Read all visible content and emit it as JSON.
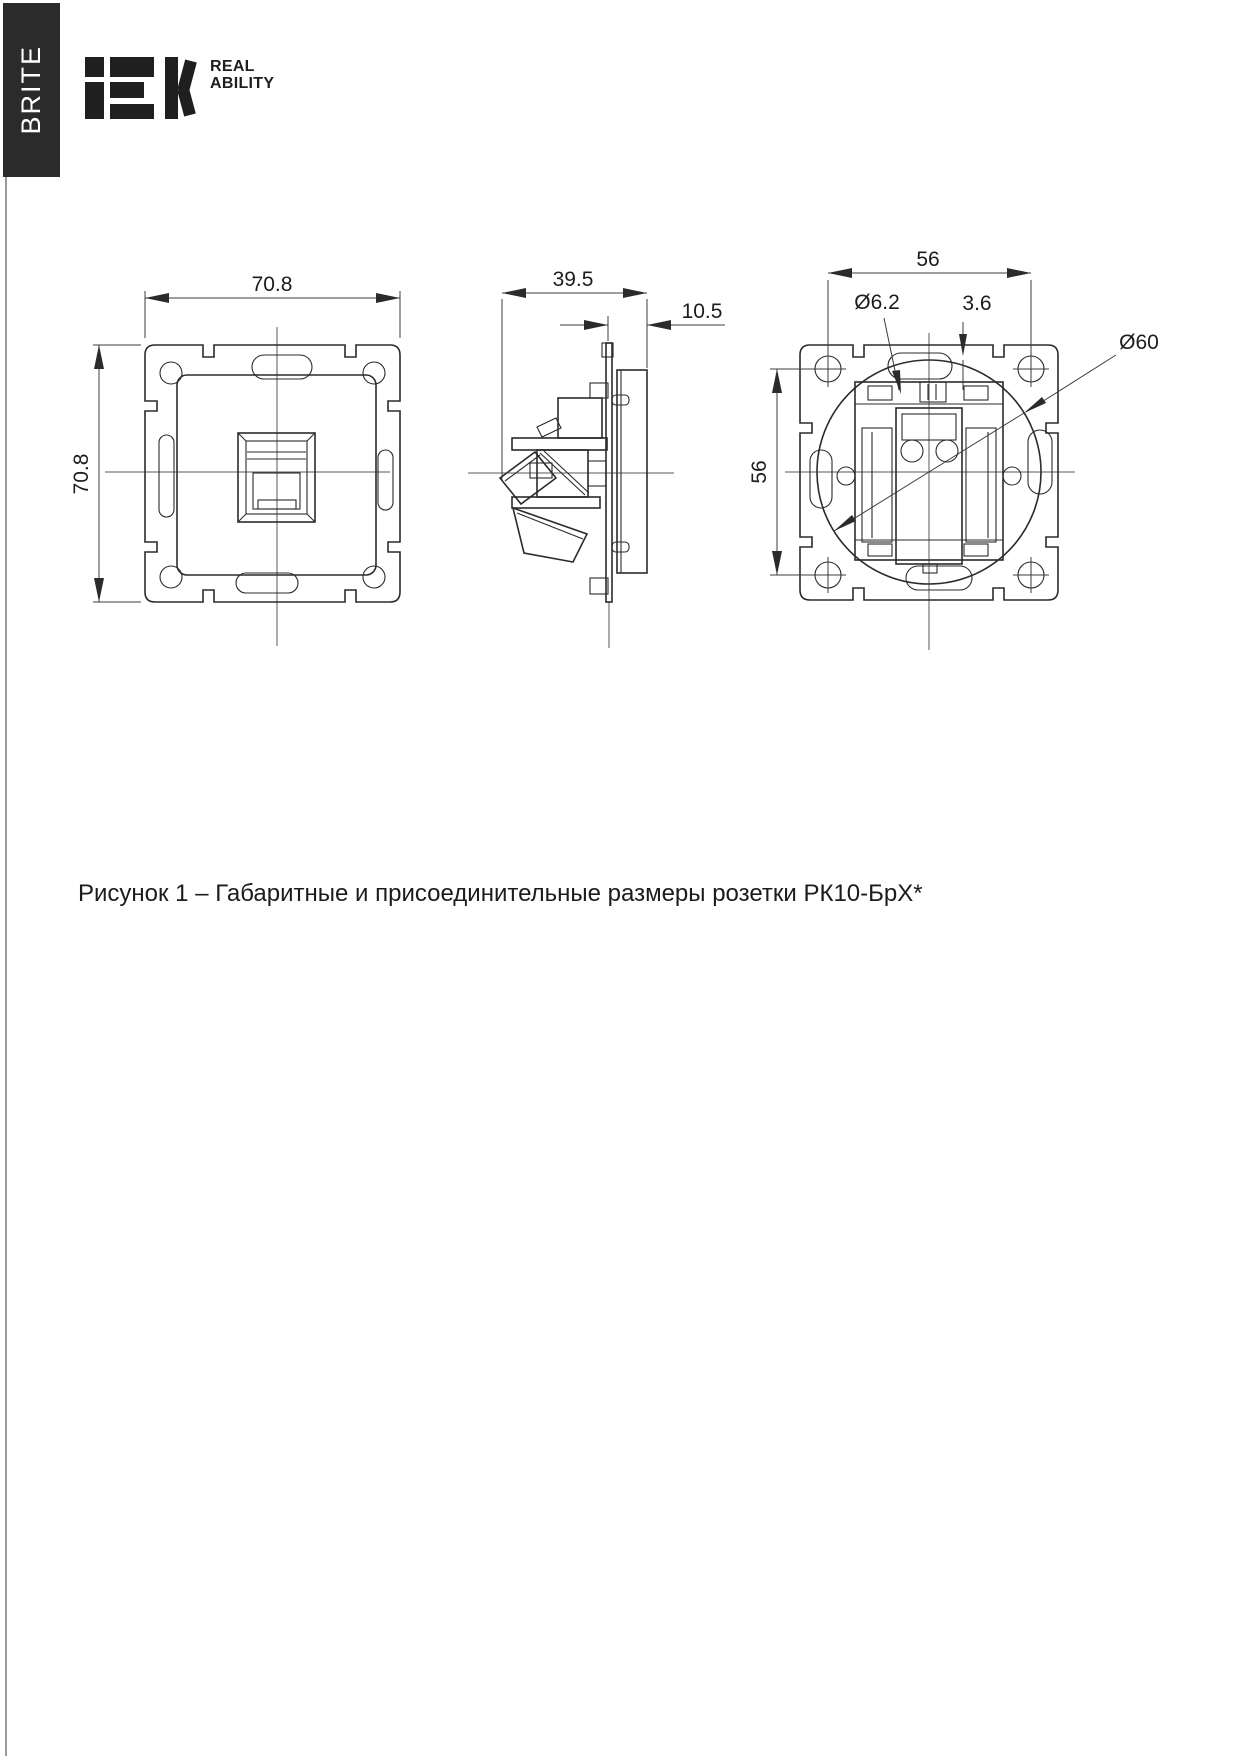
{
  "brand": {
    "banner_label": "BRITE",
    "logo_text": "IEK",
    "tagline_line1": "REAL",
    "tagline_line2": "ABILITY"
  },
  "figure": {
    "caption": "Рисунок 1 – Габаритные и присоединительные размеры розетки РК10-БрХ*"
  },
  "dimensions": {
    "front_width": "70.8",
    "front_height": "70.8",
    "side_depth": "39.5",
    "side_flange_depth": "10.5",
    "back_width": "56",
    "back_height": "56",
    "slot_diameter": "Ø6.2",
    "claw_offset": "3.6",
    "mount_circle_diameter": "Ø60"
  },
  "colors": {
    "background": "#ffffff",
    "banner_bg": "#2b2b2b",
    "banner_text": "#ffffff",
    "logo": "#1f1f1f",
    "line": "#2b2b2b"
  }
}
